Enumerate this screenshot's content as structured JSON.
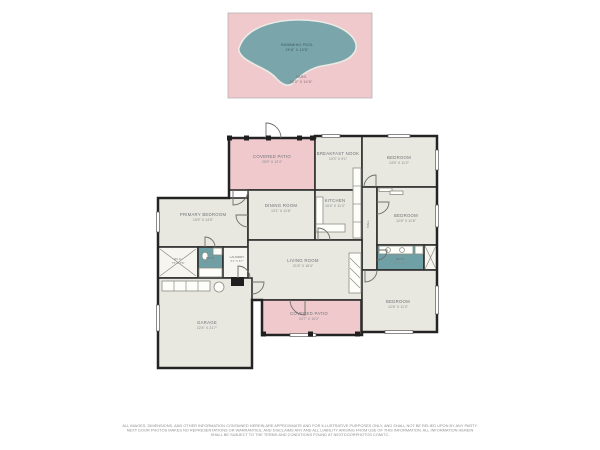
{
  "palette": {
    "patio_pink": "#f0c9cd",
    "pool_teal": "#7aa6ab",
    "room_fill": "#e9e8e0",
    "bath_teal": "#6fa0a6",
    "wall": "#2d2d2d"
  },
  "yard": {
    "pool_label": "SWIMMING POOL",
    "pool_dims": "29'8\" X 13'5\"",
    "label": "YARD",
    "dims": "28'0\" X 14'6\""
  },
  "rooms": {
    "patio_top": {
      "name": "COVERED PATIO",
      "dims": "25'9\" X 12'4\""
    },
    "breakfast": {
      "name": "BREAKFAST NOOK",
      "dims": "10'3\" X 9'1\""
    },
    "bedroom_top_right": {
      "name": "BEDROOM",
      "dims": "13'5\" X 11'2\""
    },
    "primary_bedroom": {
      "name": "PRIMARY BEDROOM",
      "dims": "15'9\" X 14'0\""
    },
    "dining": {
      "name": "DINING ROOM",
      "dims": "13'1\" X 11'6\""
    },
    "kitchen": {
      "name": "KITCHEN",
      "dims": "10'4\" X 11'3\""
    },
    "bedroom_mid_right": {
      "name": "BEDROOM",
      "dims": "12'8\" X 11'6\""
    },
    "hall": {
      "name": "HALL"
    },
    "wic": {
      "name": "W.I.C.",
      "dims": "7'5\" X 5'8\""
    },
    "bath_left": {
      "name": "BATH",
      "dims": "8'0\" X 5'6\""
    },
    "laundry": {
      "name": "LAUNDRY",
      "dims": "5'1\" X 5'7\""
    },
    "bath_right": {
      "name": "BATH",
      "dims": "9'8\" X 4'11\""
    },
    "living": {
      "name": "LIVING ROOM",
      "dims": "21'5\" X 16'4\""
    },
    "bedroom_bottom_right": {
      "name": "BEDROOM",
      "dims": "12'6\" X 11'3\""
    },
    "garage": {
      "name": "GARAGE",
      "dims": "22'4\" X 21'7\""
    },
    "patio_bottom": {
      "name": "COVERED PATIO",
      "dims": "24'7\" X 10'2\""
    }
  },
  "disclaimer": {
    "line1": "ALL IMAGES, DIMENSIONS, AND OTHER INFORMATION CONTAINED HEREIN ARE APPROXIMATE AND FOR ILLUSTRATIVE PURPOSES ONLY, AND SHALL NOT BE RELIED UPON BY ANY PARTY.",
    "line2": "NEXT DOOR PHOTOS MAKES NO REPRESENTATIONS OR WARRANTIES, AND DISCLAIMS ANY AND ALL LIABILITY ARISING FROM USE OF THIS INFORMATION. ALL INFORMATION HEREIN",
    "line3": "SHALL BE SUBJECT TO THE TERMS AND CONDITIONS FOUND AT NEXTDOORPHOTOS.COM/TC."
  }
}
